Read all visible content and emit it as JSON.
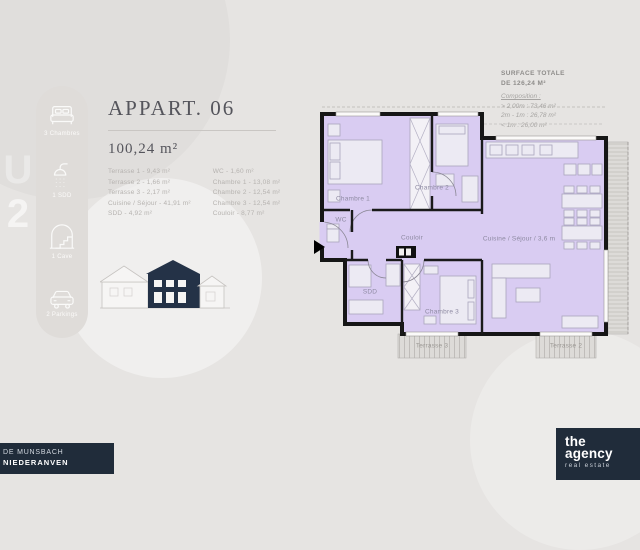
{
  "colors": {
    "background": "#e6e4e2",
    "navy": "#202c3a",
    "plan_purple": "#d9ccf2",
    "title_gray": "#55555c",
    "muted_text": "#b6b3b0"
  },
  "side_marker": {
    "glyph_top": "U",
    "glyph_bottom": "2"
  },
  "sidebar": {
    "items": [
      {
        "icon": "bed-icon",
        "label": "3 Chambres"
      },
      {
        "icon": "shower-icon",
        "label": "1 SDD"
      },
      {
        "icon": "cave-icon",
        "label": "1 Cave"
      },
      {
        "icon": "car-icon",
        "label": "2 Parkings"
      }
    ]
  },
  "header": {
    "title": "APPART. 06",
    "area": "100,24 m²"
  },
  "room_list": {
    "left": [
      "Terrasse 1 - 9,43 m²",
      "Terrasse 2 - 1,66 m²",
      "Terrasse 3 - 2,17 m²",
      "Cuisine / Séjour - 41,91 m²",
      "SDD - 4,92 m²"
    ],
    "right": [
      "WC - 1,60 m²",
      "Chambre 1 - 13,08 m²",
      "Chambre 2 - 12,54 m²",
      "Chambre 3 - 12,54 m²",
      "Couloir - 8,77 m²"
    ]
  },
  "surface_note": {
    "line1": "SURFACE TOTALE",
    "line2": "DE 126,24 M²",
    "composition_label": "Composition :",
    "items": [
      "> 2,00m : 73,46 m²",
      "2m - 1m : 26,78 m²",
      "< 1m : 26,00 m²"
    ]
  },
  "plan": {
    "labels": {
      "chambre1": "Chambre 1",
      "chambre2": "Chambre 2",
      "chambre3": "Chambre 3",
      "couloir": "Couloir",
      "cuisine": "Cuisine / Séjour / 3,6 m",
      "sdd": "SDD",
      "wc": "WC",
      "terrasse2": "Terrasse 2",
      "terrasse3": "Terrasse 3"
    }
  },
  "footer": {
    "address_line1": "DE MUNSBACH",
    "address_line2": "NIEDERANVEN",
    "logo_line1": "the",
    "logo_line2": "agency",
    "logo_sub": "real estate"
  }
}
